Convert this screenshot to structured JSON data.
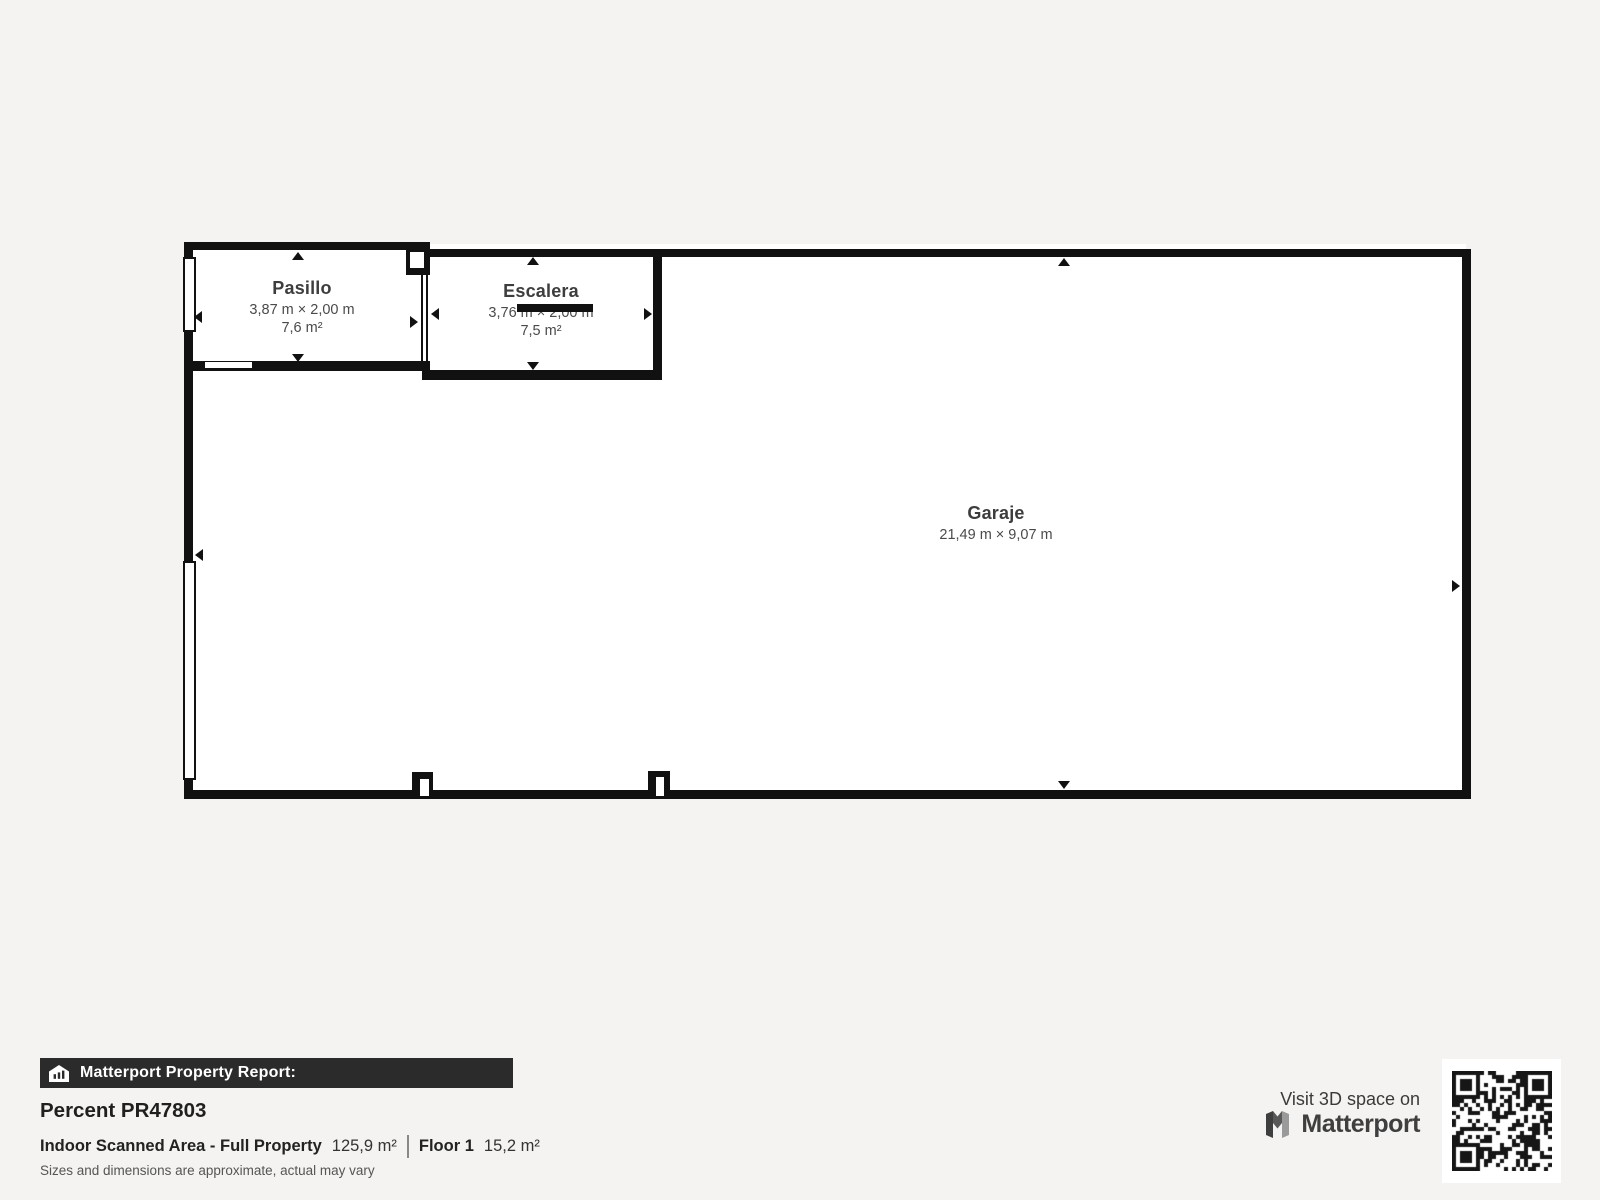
{
  "plan": {
    "rooms": [
      {
        "name": "Pasillo",
        "dims": "3,87 m × 2,00 m",
        "area": "7,6 m²"
      },
      {
        "name": "Escalera",
        "dims": "3,76 m × 2,00 m",
        "area": "7,5 m²"
      },
      {
        "name": "Garaje",
        "dims": "21,49 m × 9,07 m"
      }
    ]
  },
  "footer": {
    "report_label": "Matterport Property Report:",
    "property_name": "Percent PR47803",
    "area_label": "Indoor Scanned Area - Full Property",
    "area_value": "125,9 m²",
    "floor_label": "Floor 1",
    "floor_value": "15,2 m²",
    "disclaimer": "Sizes and dimensions are approximate, actual may vary"
  },
  "cta": {
    "visit_text": "Visit 3D space on",
    "brand": "Matterport"
  },
  "icons": {
    "report_bar": "house-chart-icon",
    "brand_mark": "matterport-m-icon",
    "qr": "qr-code"
  },
  "colors": {
    "background": "#f4f3f1",
    "wall": "#111111",
    "room_fill": "#ffffff",
    "report_bar_bg": "#2b2b2b",
    "report_bar_text": "#ffffff"
  }
}
